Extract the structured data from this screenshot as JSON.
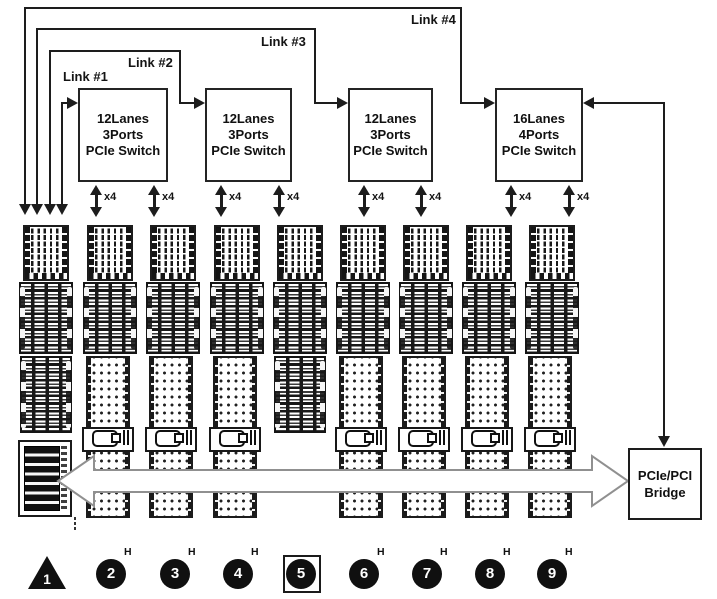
{
  "links": [
    {
      "label": "Link #1"
    },
    {
      "label": "Link #2"
    },
    {
      "label": "Link #3"
    },
    {
      "label": "Link #4"
    }
  ],
  "switches": [
    {
      "line1": "12Lanes",
      "line2": "3Ports",
      "line3": "PCIe Switch"
    },
    {
      "line1": "12Lanes",
      "line2": "3Ports",
      "line3": "PCIe Switch"
    },
    {
      "line1": "12Lanes",
      "line2": "3Ports",
      "line3": "PCIe Switch"
    },
    {
      "line1": "16Lanes",
      "line2": "4Ports",
      "line3": "PCIe Switch"
    }
  ],
  "port_label": "x4",
  "bridge": {
    "line1": "PCIe/PCI",
    "line2": "Bridge"
  },
  "markers": [
    {
      "num": "1",
      "sup": "",
      "shape": "triangle"
    },
    {
      "num": "2",
      "sup": "H",
      "shape": "circle"
    },
    {
      "num": "3",
      "sup": "H",
      "shape": "circle"
    },
    {
      "num": "4",
      "sup": "H",
      "shape": "circle"
    },
    {
      "num": "5",
      "sup": "",
      "shape": "circle-boxed"
    },
    {
      "num": "6",
      "sup": "H",
      "shape": "circle"
    },
    {
      "num": "7",
      "sup": "H",
      "shape": "circle"
    },
    {
      "num": "8",
      "sup": "H",
      "shape": "circle"
    },
    {
      "num": "9",
      "sup": "H",
      "shape": "circle"
    }
  ],
  "colors": {
    "line": "#1d1d1d",
    "bus_outline": "#909090",
    "marker_fill": "#101010"
  }
}
